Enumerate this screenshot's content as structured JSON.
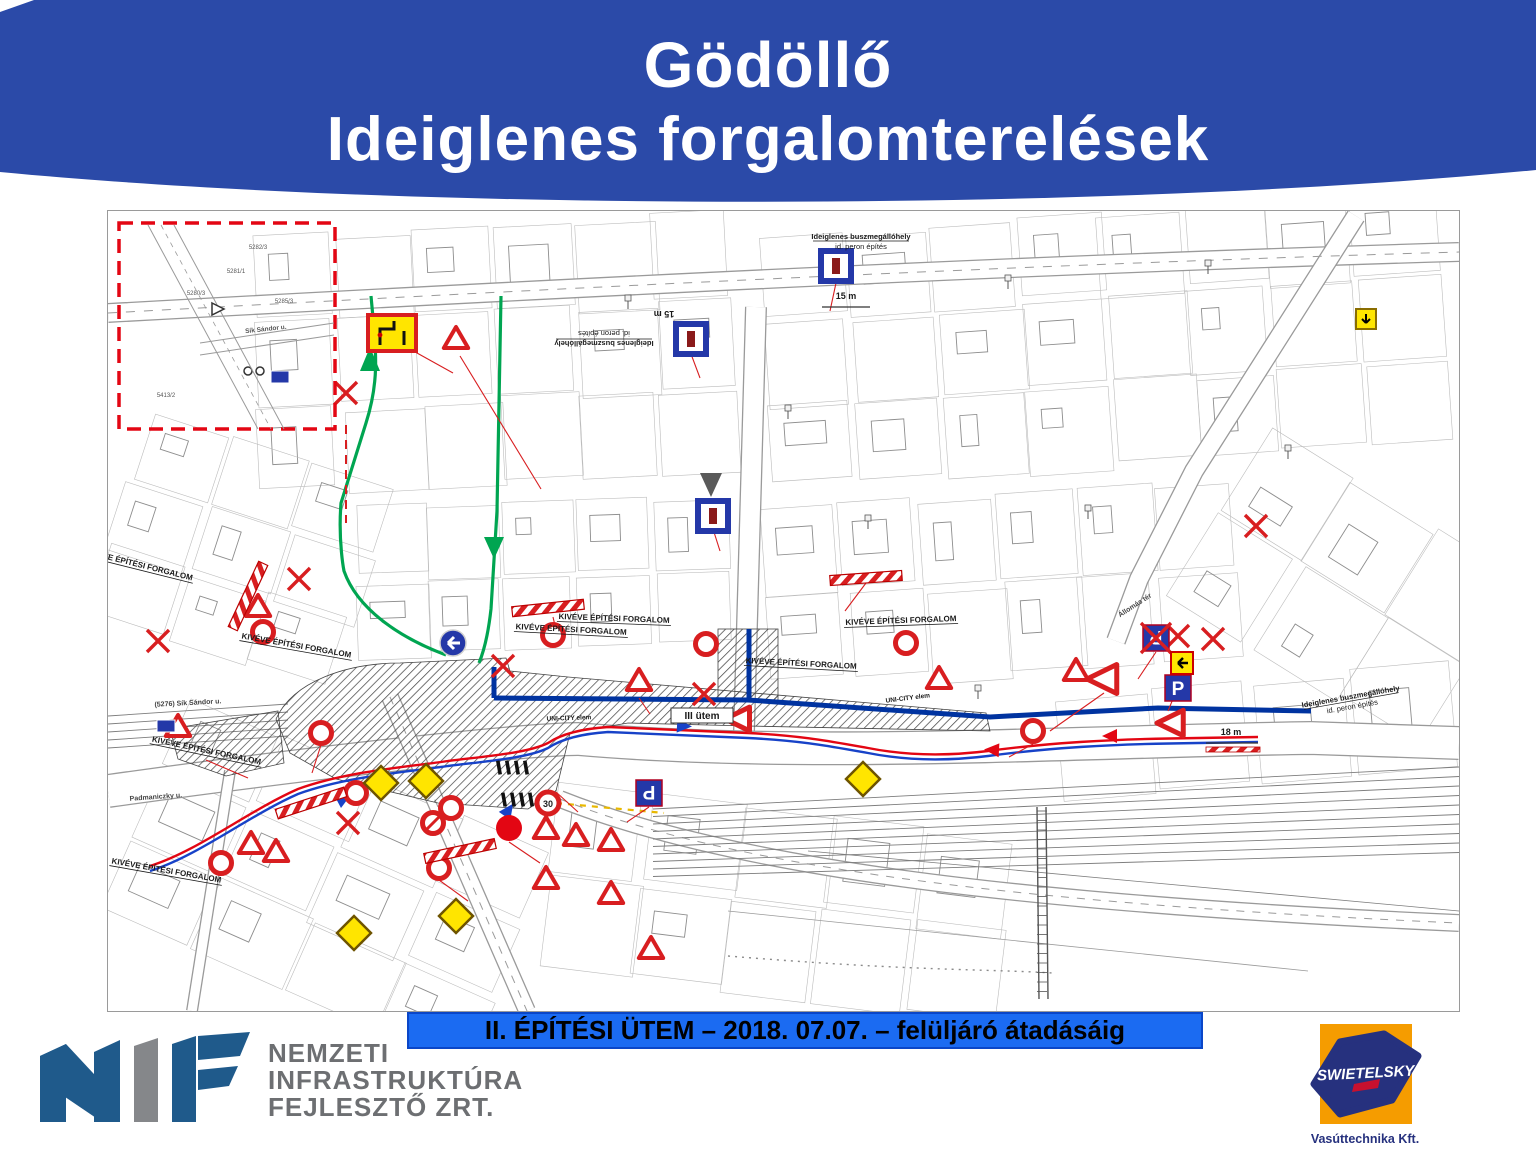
{
  "slide": {
    "title_line1": "Gödöllő",
    "title_line2": "Ideiglenes forgalomterelések",
    "banner": "II. ÉPÍTÉSI ÜTEM – 2018. 07.07. – felüljáró átadásáig"
  },
  "footer": {
    "nif": {
      "line1": "NEMZETI",
      "line2": "INFRASTRUKTÚRA",
      "line3": "FEJLESZTŐ ZRT."
    },
    "swietelsky": {
      "brand": "SWIETELSKY",
      "subtitle": "Vasúttechnika Kft."
    }
  },
  "map": {
    "labels": {
      "kiveve": "KIVÉVE ÉPÍTÉSI FORGALOM",
      "utem3": "III ütem",
      "unicity": "UNI-CITY elem",
      "bus_stop_line1": "Ideiglenes buszmegállóhely",
      "bus_stop_line2": "id. peron építés",
      "dim15": "15 m",
      "dim18": "18 m",
      "speed30": "30",
      "sik_sandor": "Sík Sándor u.",
      "sik_sandor_num": "(5276) Sík Sándor u.",
      "padmaniczky": "Padmaniczky u.",
      "allomas_ter": "Állomás tér",
      "parcels": [
        "5282/3",
        "5281/1",
        "5280/3",
        "5285/3",
        "5413/2"
      ]
    },
    "colors": {
      "header_blue": "#2B4AA8",
      "banner_blue": "#1B6BF2",
      "detour_green": "#00A551",
      "closure_blue": "#0033A0",
      "route_red": "#E30613",
      "route_blue": "#1742C8",
      "sign_red": "#D81E20",
      "sign_yellow": "#FFE500",
      "sign_blue": "#2438A8"
    },
    "sign_types": [
      "prohibition-ring-sign",
      "speed-30-sign",
      "no-stopping-sign",
      "warning-triangle-sign",
      "give-way-arrow-sign",
      "priority-road-diamond-sign",
      "closed-x-mark",
      "roadwork-barrier",
      "bus-stop-sign",
      "parking-p-sign",
      "mandatory-left-arrow-sign",
      "detour-map-sign",
      "closure-point"
    ]
  }
}
